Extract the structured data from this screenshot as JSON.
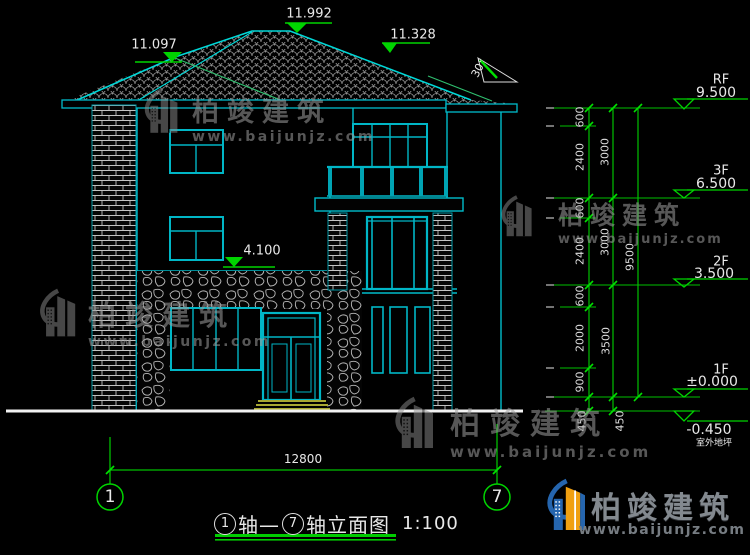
{
  "top_markers": {
    "left_ridge": "11.097",
    "main_ridge": "11.992",
    "right_ridge": "11.328",
    "stone_top": "4.100"
  },
  "roof_slope_label": "30°",
  "levels": [
    {
      "label": "RF",
      "value": "9.500"
    },
    {
      "label": "3F",
      "value": "6.500"
    },
    {
      "label": "2F",
      "value": "3.500"
    },
    {
      "label": "1F",
      "value": "±0.000"
    },
    {
      "label": "",
      "value": "-0.450",
      "sub": "室外地坪"
    }
  ],
  "dims": {
    "col_a": [
      "600",
      "2400",
      "600",
      "2400",
      "600",
      "2000",
      "900",
      "450"
    ],
    "col_b": [
      "3000",
      "3000",
      "3500",
      "450"
    ],
    "col_c": [
      "9500"
    ],
    "bottom": "12800"
  },
  "axes": {
    "left": "1",
    "right": "7"
  },
  "title": {
    "circle_left": "1",
    "mid": "轴—",
    "circle_right": "7",
    "text": "轴立面图",
    "scale": "1:100"
  },
  "watermark": {
    "brand": "柏竣建筑",
    "url": "www.baijunjz.com"
  },
  "logo": {
    "brand": "柏竣建筑",
    "url": "www.baijunjz.com"
  },
  "colors": {
    "line_cyan": "#00bccb",
    "dim_green": "#00d400",
    "step_olive": "#a8a832",
    "ground_white": "#f2f2f2"
  }
}
